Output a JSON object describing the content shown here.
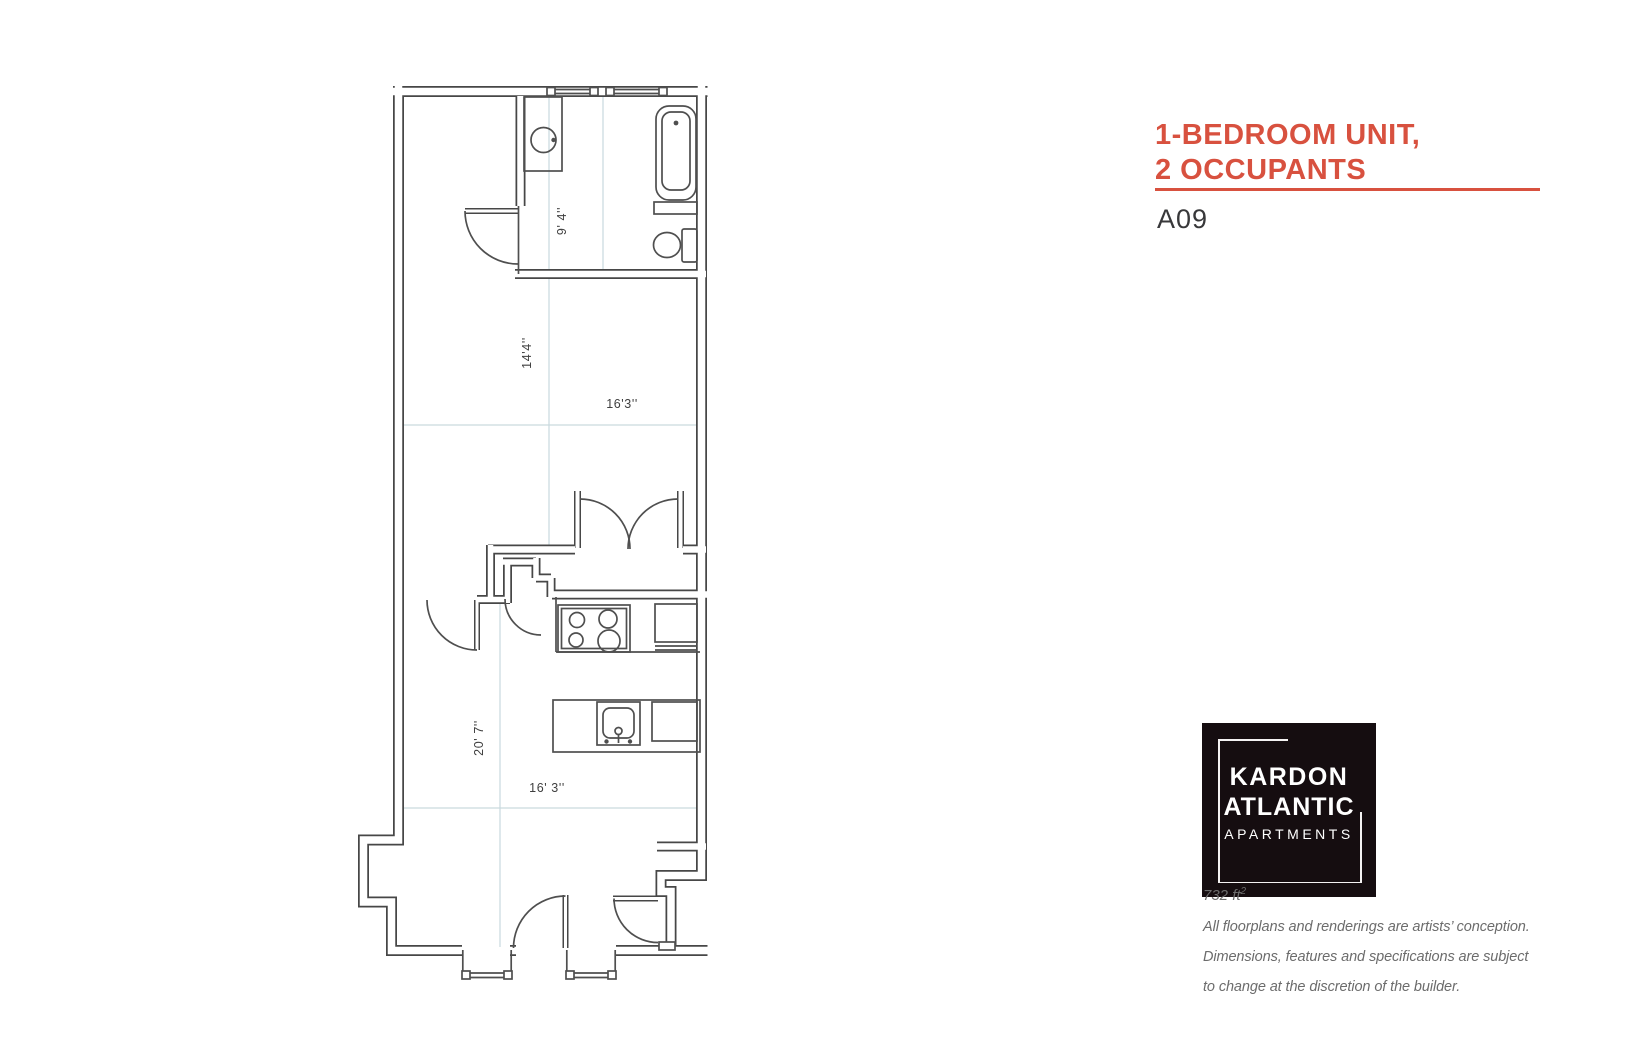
{
  "panel": {
    "title_line1": "1-BEDROOM UNIT,",
    "title_line2": "2 OCCUPANTS",
    "unit_code": "A09",
    "logo": {
      "name_line1": "KARDON",
      "name_line2": "ATLANTIC",
      "name_line3": "APARTMENTS"
    },
    "area_value": "732 ft",
    "area_superscript": "2",
    "disclaimer_line1": "All floorplans and renderings are artists’ conception.",
    "disclaimer_line2": "Dimensions, features and specifications are subject",
    "disclaimer_line3": "to change at the discretion of the builder."
  },
  "floorplan": {
    "dimensions": {
      "bathroom_width": "9' 4''",
      "bedroom_depth": "14'4''",
      "bedroom_width": "16'3''",
      "living_depth": "20' 7''",
      "living_width": "16' 3''"
    }
  },
  "colors": {
    "accent": "#D8513F",
    "wall_line": "#474747",
    "logo_background": "#150d10",
    "muted_text": "#6c6c6c",
    "guide_line": "#c9d9de"
  }
}
